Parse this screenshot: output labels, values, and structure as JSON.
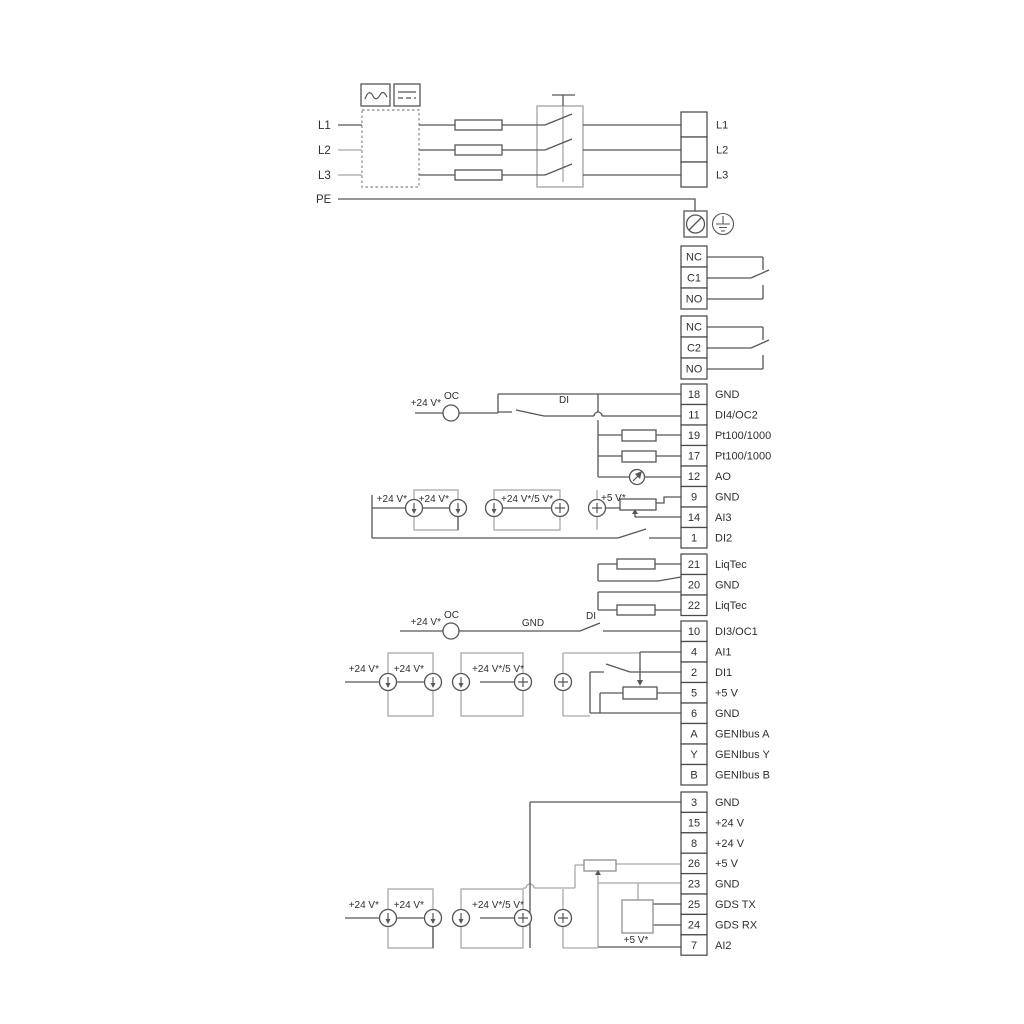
{
  "colors": {
    "wire_dark": "#565656",
    "wire_light": "#a8a8a8",
    "box_stroke": "#4a4a4a",
    "text": "#2f2f2f",
    "background": "#ffffff"
  },
  "mains": {
    "inputs": [
      "L1",
      "L2",
      "L3",
      "PE"
    ],
    "outputs": [
      "L1",
      "L2",
      "L3"
    ]
  },
  "relays": [
    [
      "NC",
      "C1",
      "NO"
    ],
    [
      "NC",
      "C2",
      "NO"
    ]
  ],
  "blocks": {
    "io_top": [
      [
        "18",
        "GND"
      ],
      [
        "11",
        "DI4/OC2"
      ],
      [
        "19",
        "Pt100/1000"
      ],
      [
        "17",
        "Pt100/1000"
      ],
      [
        "12",
        "AO"
      ],
      [
        "9",
        "GND"
      ],
      [
        "14",
        "AI3"
      ],
      [
        "1",
        "DI2"
      ]
    ],
    "liqtec": [
      [
        "21",
        "LiqTec"
      ],
      [
        "20",
        "GND"
      ],
      [
        "22",
        "LiqTec"
      ]
    ],
    "io_mid": [
      [
        "10",
        "DI3/OC1"
      ],
      [
        "4",
        "AI1"
      ],
      [
        "2",
        "DI1"
      ],
      [
        "5",
        "+5 V"
      ],
      [
        "6",
        "GND"
      ],
      [
        "A",
        "GENIbus A"
      ],
      [
        "Y",
        "GENIbus Y"
      ],
      [
        "B",
        "GENIbus B"
      ]
    ],
    "io_bottom": [
      [
        "3",
        "GND"
      ],
      [
        "15",
        "+24 V"
      ],
      [
        "8",
        "+24 V"
      ],
      [
        "26",
        "+5 V"
      ],
      [
        "23",
        "GND"
      ],
      [
        "25",
        "GDS TX"
      ],
      [
        "24",
        "GDS RX"
      ],
      [
        "7",
        "AI2"
      ]
    ]
  },
  "annotations": {
    "oc2": {
      "supply": "+24 V*",
      "oc": "OC",
      "di": "DI"
    },
    "ai3": {
      "s1": "+24 V*",
      "s2": "+24 V*",
      "s3": "+24 V*/5 V*",
      "s4": "+5 V*"
    },
    "oc1": {
      "supply": "+24 V*",
      "oc": "OC",
      "gnd": "GND",
      "di": "DI"
    },
    "ai1": {
      "s1": "+24 V*",
      "s2": "+24 V*",
      "s3": "+24 V*/5 V*"
    },
    "ai2": {
      "s1": "+24 V*",
      "s2": "+24 V*",
      "s3": "+24 V*/5 V*",
      "s4": "+5 V*"
    }
  }
}
